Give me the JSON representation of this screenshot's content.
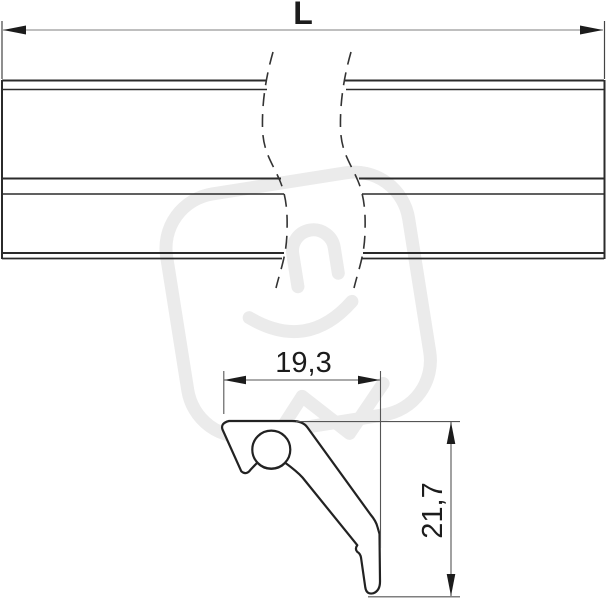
{
  "drawing": {
    "type": "technical-dimension-drawing",
    "top_view": {
      "description_name": "rail-side-view-with-break",
      "length_dimension_label": "L"
    },
    "section_view": {
      "description_name": "profile-cross-section",
      "width_dimension_label": "19,3",
      "height_dimension_label": "21,7"
    },
    "colors": {
      "ink": "#2b2b2b",
      "dimension_line": "#8a8a8a",
      "extension_line": "#555555",
      "watermark": "#ebebeb",
      "background": "#ffffff"
    },
    "watermark_icon": "plug-logo-watermark"
  }
}
